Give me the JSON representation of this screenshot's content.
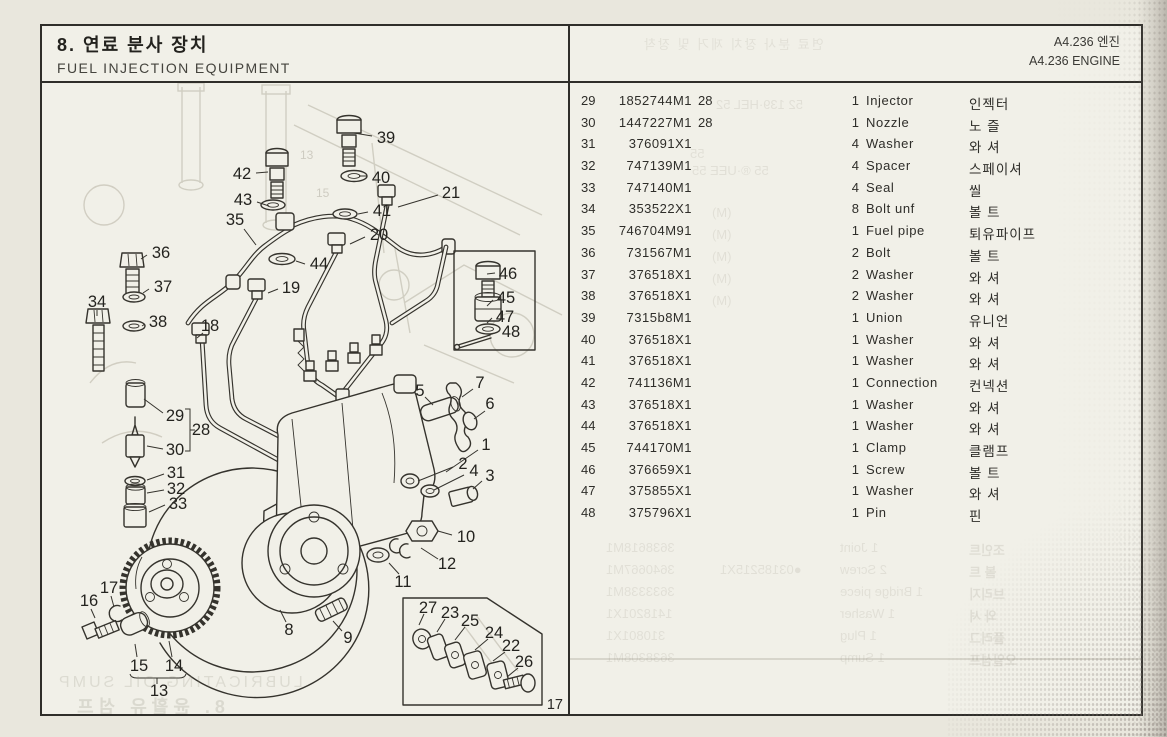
{
  "header": {
    "section_title_ko": "8. 연료 분사 장치",
    "section_title_en": "FUEL INJECTION EQUIPMENT",
    "engine_ko": "A4.236 엔진",
    "engine_en": "A4.236 ENGINE"
  },
  "page_number": "17",
  "parts_table": {
    "columns": [
      "ref",
      "part_number",
      "note",
      "qty",
      "description",
      "description_ko"
    ],
    "rows": [
      {
        "no": "29",
        "part": "1852744M1",
        "note": "28",
        "qty": "1",
        "name": "Injector",
        "ko": "인젝터"
      },
      {
        "no": "30",
        "part": "1447227M1",
        "note": "28",
        "qty": "1",
        "name": "Nozzle",
        "ko": "노 즐"
      },
      {
        "no": "31",
        "part": "376091X1",
        "note": "",
        "qty": "4",
        "name": "Washer",
        "ko": "와 셔"
      },
      {
        "no": "32",
        "part": "747139M1",
        "note": "",
        "qty": "4",
        "name": "Spacer",
        "ko": "스페이셔"
      },
      {
        "no": "33",
        "part": "747140M1",
        "note": "",
        "qty": "4",
        "name": "Seal",
        "ko": "씰"
      },
      {
        "no": "34",
        "part": "353522X1",
        "note": "",
        "qty": "8",
        "name": "Bolt unf",
        "ko": "볼 트"
      },
      {
        "no": "35",
        "part": "746704M91",
        "note": "",
        "qty": "1",
        "name": "Fuel pipe",
        "ko": "퇴유파이프"
      },
      {
        "no": "36",
        "part": "731567M1",
        "note": "",
        "qty": "2",
        "name": "Bolt",
        "ko": "볼 트"
      },
      {
        "no": "37",
        "part": "376518X1",
        "note": "",
        "qty": "2",
        "name": "Washer",
        "ko": "와 셔"
      },
      {
        "no": "38",
        "part": "376518X1",
        "note": "",
        "qty": "2",
        "name": "Washer",
        "ko": "와 셔"
      },
      {
        "no": "39",
        "part": "7315b8M1",
        "note": "",
        "qty": "1",
        "name": "Union",
        "ko": "유니언"
      },
      {
        "no": "40",
        "part": "376518X1",
        "note": "",
        "qty": "1",
        "name": "Washer",
        "ko": "와 셔"
      },
      {
        "no": "41",
        "part": "376518X1",
        "note": "",
        "qty": "1",
        "name": "Washer",
        "ko": "와 셔"
      },
      {
        "no": "42",
        "part": "741136M1",
        "note": "",
        "qty": "1",
        "name": "Connection",
        "ko": "컨넥션"
      },
      {
        "no": "43",
        "part": "376518X1",
        "note": "",
        "qty": "1",
        "name": "Washer",
        "ko": "와 셔"
      },
      {
        "no": "44",
        "part": "376518X1",
        "note": "",
        "qty": "1",
        "name": "Washer",
        "ko": "와 셔"
      },
      {
        "no": "45",
        "part": "744170M1",
        "note": "",
        "qty": "1",
        "name": "Clamp",
        "ko": "클램프"
      },
      {
        "no": "46",
        "part": "376659X1",
        "note": "",
        "qty": "1",
        "name": "Screw",
        "ko": "볼 트"
      },
      {
        "no": "47",
        "part": "375855X1",
        "note": "",
        "qty": "1",
        "name": "Washer",
        "ko": "와 셔"
      },
      {
        "no": "48",
        "part": "375796X1",
        "note": "",
        "qty": "1",
        "name": "Pin",
        "ko": "핀"
      }
    ]
  },
  "diagram": {
    "callouts": [
      {
        "n": "39",
        "x": 344,
        "y": 55,
        "l": [
          330,
          53,
          312,
          50
        ]
      },
      {
        "n": "42",
        "x": 200,
        "y": 91,
        "l": [
          214,
          90,
          226,
          89
        ]
      },
      {
        "n": "40",
        "x": 339,
        "y": 95,
        "l": [
          325,
          93,
          317,
          93
        ]
      },
      {
        "n": "21",
        "x": 409,
        "y": 110,
        "l": [
          396,
          112,
          356,
          124
        ]
      },
      {
        "n": "43",
        "x": 201,
        "y": 117,
        "l": [
          215,
          119,
          227,
          123
        ]
      },
      {
        "n": "41",
        "x": 340,
        "y": 128,
        "l": [
          326,
          129,
          316,
          131
        ]
      },
      {
        "n": "35",
        "x": 193,
        "y": 137,
        "l": [
          202,
          146,
          214,
          162
        ]
      },
      {
        "n": "20",
        "x": 337,
        "y": 152,
        "l": [
          323,
          154,
          308,
          161
        ]
      },
      {
        "n": "36",
        "x": 119,
        "y": 170,
        "l": [
          105,
          172,
          99,
          176
        ]
      },
      {
        "n": "44",
        "x": 277,
        "y": 181,
        "l": [
          263,
          181,
          254,
          178
        ]
      },
      {
        "n": "37",
        "x": 121,
        "y": 204,
        "l": [
          107,
          206,
          101,
          210
        ]
      },
      {
        "n": "19",
        "x": 249,
        "y": 205,
        "l": [
          236,
          206,
          226,
          210
        ]
      },
      {
        "n": "34",
        "x": 55,
        "y": 219,
        "l": [
          55,
          227,
          55,
          233
        ]
      },
      {
        "n": "38",
        "x": 116,
        "y": 239,
        "l": [
          103,
          241,
          100,
          243
        ]
      },
      {
        "n": "18",
        "x": 168,
        "y": 243,
        "l": [
          161,
          250,
          155,
          255
        ]
      },
      {
        "n": "46",
        "x": 466,
        "y": 191,
        "l": [
          453,
          190,
          445,
          191
        ]
      },
      {
        "n": "45",
        "x": 464,
        "y": 215,
        "l": [
          451,
          217,
          445,
          223
        ]
      },
      {
        "n": "47",
        "x": 463,
        "y": 234,
        "l": [
          450,
          235,
          445,
          240
        ]
      },
      {
        "n": "48",
        "x": 469,
        "y": 249,
        "l": [
          456,
          249,
          447,
          252
        ]
      },
      {
        "n": "29",
        "x": 133,
        "y": 333,
        "l": [
          121,
          330,
          102,
          316
        ]
      },
      {
        "n": "28",
        "x": 159,
        "y": 347,
        "l": null
      },
      {
        "n": "30",
        "x": 133,
        "y": 367,
        "l": [
          121,
          366,
          105,
          363
        ]
      },
      {
        "n": "31",
        "x": 134,
        "y": 390,
        "l": [
          122,
          391,
          105,
          397
        ]
      },
      {
        "n": "32",
        "x": 134,
        "y": 406,
        "l": [
          122,
          407,
          105,
          410
        ]
      },
      {
        "n": "33",
        "x": 136,
        "y": 421,
        "l": [
          123,
          422,
          107,
          429
        ]
      },
      {
        "n": "5",
        "x": 378,
        "y": 308,
        "l": [
          383,
          314,
          391,
          322
        ]
      },
      {
        "n": "7",
        "x": 438,
        "y": 300,
        "l": [
          431,
          306,
          420,
          314
        ]
      },
      {
        "n": "6",
        "x": 448,
        "y": 321,
        "l": [
          443,
          328,
          432,
          336
        ]
      },
      {
        "n": "1",
        "x": 444,
        "y": 362,
        "l": [
          436,
          367,
          404,
          389
        ]
      },
      {
        "n": "2",
        "x": 421,
        "y": 381,
        "l": [
          411,
          384,
          376,
          398
        ]
      },
      {
        "n": "4",
        "x": 432,
        "y": 388,
        "l": [
          422,
          392,
          392,
          407
        ]
      },
      {
        "n": "3",
        "x": 448,
        "y": 393,
        "l": [
          440,
          398,
          431,
          406
        ]
      },
      {
        "n": "10",
        "x": 424,
        "y": 454,
        "l": [
          410,
          452,
          396,
          448
        ]
      },
      {
        "n": "12",
        "x": 405,
        "y": 481,
        "l": [
          396,
          476,
          379,
          465
        ]
      },
      {
        "n": "11",
        "x": 361,
        "y": 499,
        "l": [
          357,
          491,
          347,
          480
        ]
      },
      {
        "n": "8",
        "x": 247,
        "y": 547,
        "l": [
          244,
          539,
          238,
          527
        ]
      },
      {
        "n": "9",
        "x": 306,
        "y": 555,
        "l": [
          300,
          548,
          291,
          538
        ]
      },
      {
        "n": "16",
        "x": 47,
        "y": 518,
        "l": [
          49,
          526,
          53,
          535
        ]
      },
      {
        "n": "17",
        "x": 67,
        "y": 505,
        "l": [
          69,
          513,
          72,
          524
        ]
      },
      {
        "n": "15",
        "x": 97,
        "y": 583,
        "l": [
          95,
          574,
          93,
          561
        ]
      },
      {
        "n": "14",
        "x": 132,
        "y": 583,
        "l": [
          130,
          574,
          127,
          558
        ]
      },
      {
        "n": "13",
        "x": 117,
        "y": 608,
        "l": null
      },
      {
        "n": "27",
        "x": 386,
        "y": 525,
        "l": [
          382,
          531,
          377,
          542
        ]
      },
      {
        "n": "23",
        "x": 408,
        "y": 530,
        "l": [
          403,
          536,
          395,
          549
        ]
      },
      {
        "n": "25",
        "x": 428,
        "y": 538,
        "l": [
          423,
          544,
          413,
          557
        ]
      },
      {
        "n": "24",
        "x": 452,
        "y": 550,
        "l": [
          446,
          556,
          433,
          567
        ]
      },
      {
        "n": "22",
        "x": 469,
        "y": 563,
        "l": [
          463,
          569,
          451,
          578
        ]
      },
      {
        "n": "26",
        "x": 482,
        "y": 579,
        "l": [
          476,
          585,
          465,
          594
        ]
      }
    ]
  },
  "bleed_through": {
    "right_header": "연료 분사 장치 제거 및 장착",
    "left_en": "LUBRICATING OIL SUMP",
    "left_ko": "8. 윤활유 섬프",
    "marks": [
      {
        "x": 146,
        "y": 14,
        "t": "52 139·HEL 52"
      },
      {
        "x": 120,
        "y": 63,
        "t": "55"
      },
      {
        "x": 122,
        "y": 80,
        "t": "55 ®·UEE 55"
      },
      {
        "x": 142,
        "y": 122,
        "t": "(M)"
      },
      {
        "x": 142,
        "y": 144,
        "t": "(M)"
      },
      {
        "x": 142,
        "y": 166,
        "t": "(M)"
      },
      {
        "x": 142,
        "y": 188,
        "t": "(M)"
      },
      {
        "x": 142,
        "y": 210,
        "t": "(M)"
      }
    ],
    "ghost_rows": [
      {
        "part": "3638618M1",
        "extra": "",
        "qn": "1 Joint",
        "ko": "조인트"
      },
      {
        "part": "3640667M1",
        "extra": "●03185215X1",
        "qn": "2 Screw",
        "ko": "볼 트"
      },
      {
        "part": "3633338M1",
        "extra": "",
        "qn": "1 Bridge piece",
        "ko": "브리지"
      },
      {
        "part": "1418201X1",
        "extra": "",
        "qn": "1 Washer",
        "ko": "와 셔"
      },
      {
        "part": "310801X1",
        "extra": "",
        "qn": "1 Plug",
        "ko": "플러그"
      },
      {
        "part": "3638308M1",
        "extra": "",
        "qn": "1 Sump",
        "ko": "오일섬프"
      }
    ]
  }
}
